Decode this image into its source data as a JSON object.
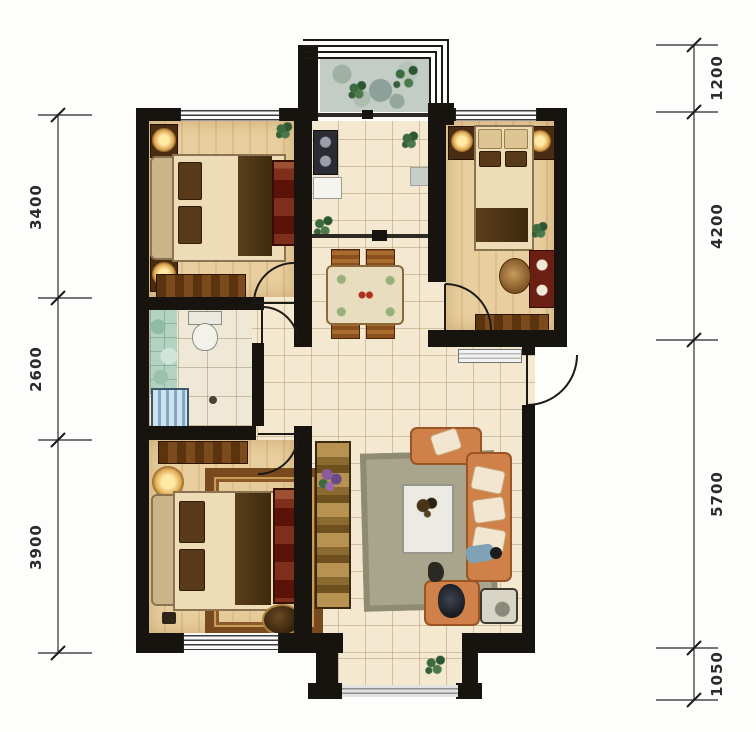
{
  "plan": {
    "dims_left": [
      {
        "label": "3400"
      },
      {
        "label": "2600"
      },
      {
        "label": "3900"
      }
    ],
    "dims_right": [
      {
        "label": "1200"
      },
      {
        "label": "4200"
      },
      {
        "label": "5700"
      },
      {
        "label": "1050"
      }
    ],
    "colors": {
      "wall": "#17130f",
      "tile_floor": "#f4e9d0",
      "wood_floor": "#e2c493",
      "balcony_stone": "#c3cdc5",
      "sofa_orange": "#d08049",
      "cabinet_red": "#6e2014",
      "rug_olive": "#a9a58c",
      "dim_text": "#2b2b2b"
    }
  }
}
